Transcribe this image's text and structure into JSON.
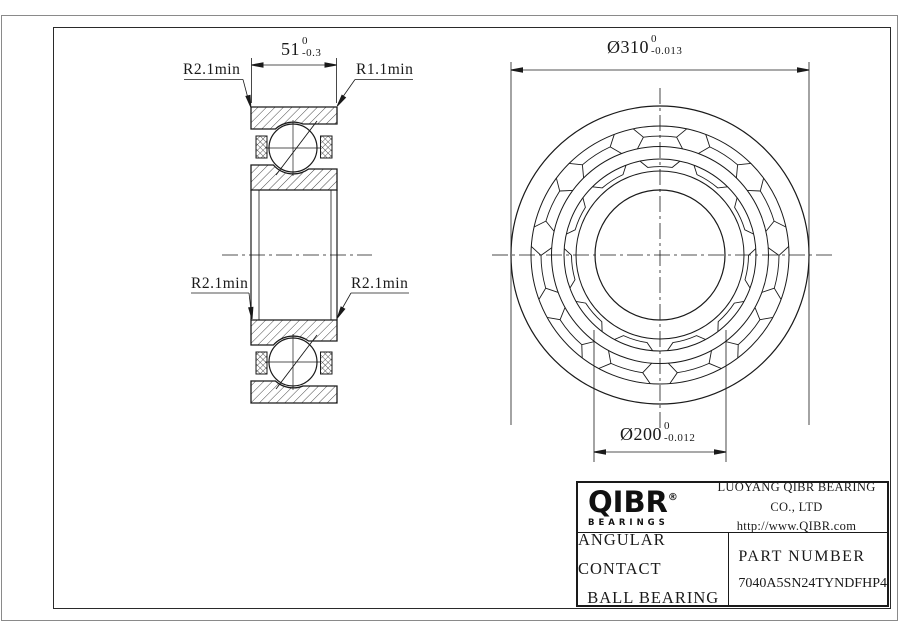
{
  "drawing": {
    "left_view": {
      "dim_width": {
        "value": "51",
        "tol_upper": "0",
        "tol_lower": "-0.3"
      },
      "label_top_left": "R2.1min",
      "label_top_right": "R1.1min",
      "label_mid_left": "R2.1min",
      "label_mid_right": "R2.1min"
    },
    "right_view": {
      "dim_outer": {
        "value": "Ø310",
        "tol_upper": "0",
        "tol_lower": "-0.013"
      },
      "dim_bore": {
        "value": "Ø200",
        "tol_upper": "0",
        "tol_lower": "-0.012"
      }
    }
  },
  "title_block": {
    "logo_text": "QIBR",
    "logo_reg": "®",
    "logo_sub": "BEARINGS",
    "company": "LUOYANG QIBR BEARING CO., LTD",
    "website": "http://www.QIBR.com",
    "product_line1": "ANGULAR CONTACT",
    "product_line2": "BALL BEARING",
    "part_label": "PART NUMBER",
    "part_number": "7040A5SN24TYNDFHP4"
  },
  "colors": {
    "line": "#1a1a1a",
    "background": "#ffffff",
    "border_outer": "#8a8a8a"
  }
}
